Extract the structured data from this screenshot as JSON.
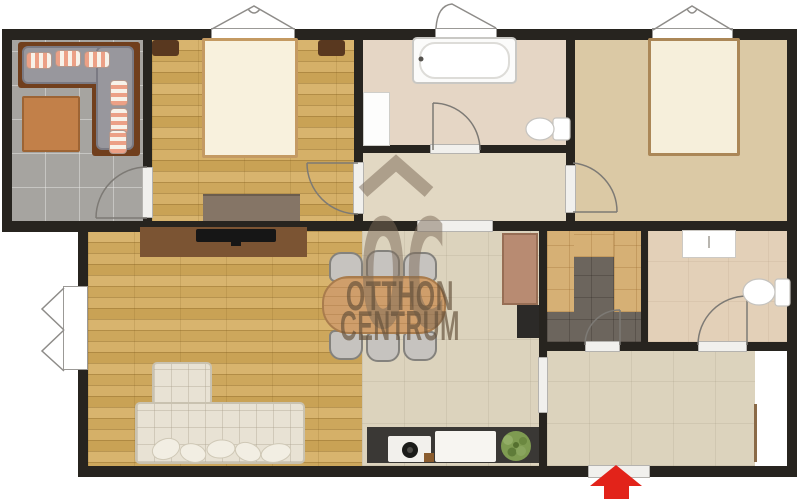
{
  "watermark": {
    "logo": "OC",
    "line1": "OTTHON",
    "line2": "CENTRUM"
  },
  "entrance_arrow": {
    "direction": "up",
    "color": "#e2231a"
  },
  "colors": {
    "wall": "#27241f",
    "accent_red": "#e2231a",
    "watermark_text": "rgba(99,79,58,0.66)"
  }
}
